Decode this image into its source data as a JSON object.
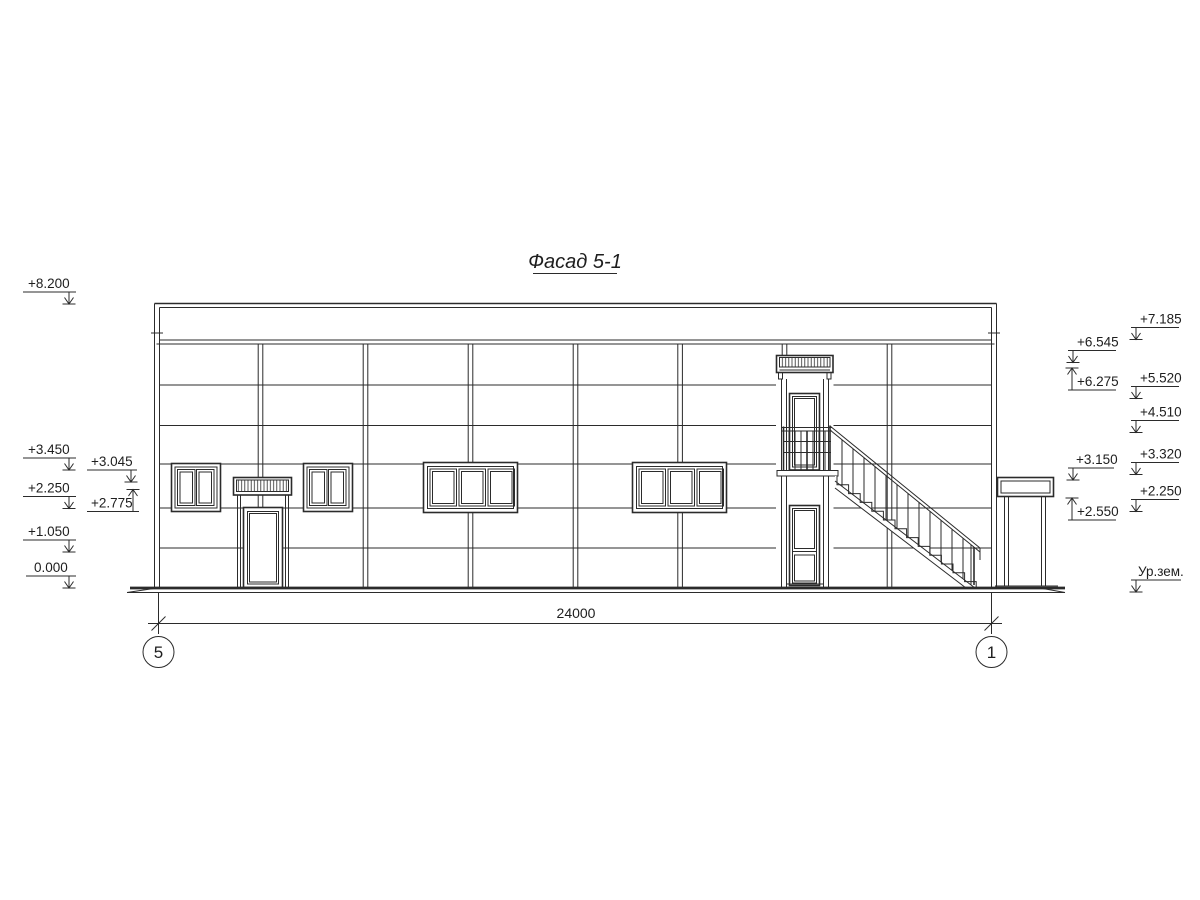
{
  "title": "Фасад 5-1",
  "dimension_label": "24000",
  "axis_bubbles": {
    "left": "5",
    "right": "1"
  },
  "elevation_marks": {
    "left_outer": [
      "+8.200",
      "+3.450",
      "+2.250",
      "+1.050",
      "0.000"
    ],
    "left_inner": [
      "+3.045",
      "+2.775"
    ],
    "right_inner": [
      "+6.545",
      "+6.275",
      "+3.150",
      "+2.550"
    ],
    "right_outer": [
      "+7.185",
      "+5.520",
      "+4.510",
      "+3.320",
      "+2.250",
      "Ур.зем."
    ]
  },
  "colors": {
    "line": "#2b2b2b",
    "background": "#ffffff"
  }
}
